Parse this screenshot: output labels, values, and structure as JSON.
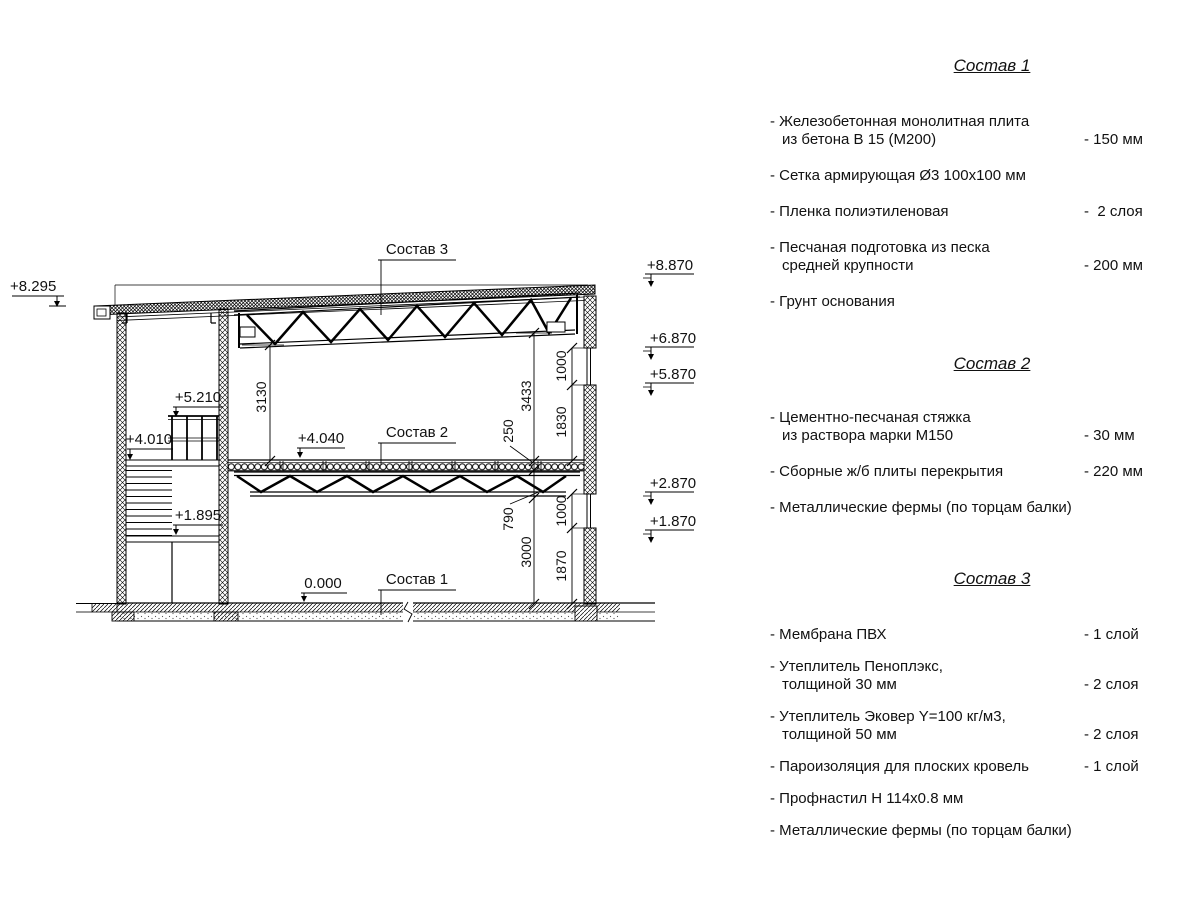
{
  "drawing": {
    "callouts": {
      "c3": "Состав 3",
      "c2": "Состав 2",
      "c1": "Состав 1"
    },
    "elevations": {
      "m8295": "+8.295",
      "m8870": "+8.870",
      "m6870": "+6.870",
      "m5870": "+5.870",
      "m2870": "+2.870",
      "m1870": "+1.870",
      "m5210": "+5.210",
      "m4010": "+4.010",
      "m1895": "+1.895",
      "m4040": "+4.040",
      "m0000": "0.000"
    },
    "dims": {
      "d3130": "3130",
      "d3433": "3433",
      "d250": "250",
      "d790": "790",
      "d3000": "3000",
      "d1000a": "1000",
      "d1830": "1830",
      "d1000b": "1000",
      "d1870": "1870"
    },
    "line_color": "#000000",
    "background_color": "#ffffff"
  },
  "specs": {
    "sections": [
      {
        "title": "Состав 1",
        "items": [
          {
            "line1": "- Железобетонная  монолитная плита",
            "line2": "из бетона В 15 (М200)",
            "value": "- 150 мм"
          },
          {
            "line1": "- Сетка армирующая Ø3 100x100 мм"
          },
          {
            "line1": "- Пленка полиэтиленовая",
            "value": "-  2 слоя"
          },
          {
            "line1": "- Песчаная подготовка из песка",
            "line2": "средней крупности",
            "value": "- 200 мм"
          },
          {
            "line1": "- Грунт основания"
          }
        ]
      },
      {
        "title": "Состав 2",
        "items": [
          {
            "line1": "- Цементно-песчаная стяжка",
            "line2": "из раствора марки М150",
            "value": "- 30 мм"
          },
          {
            "line1": "- Сборные ж/б плиты перекрытия",
            "value": "- 220 мм"
          },
          {
            "line1": "- Металлические фермы (по торцам балки)"
          }
        ]
      },
      {
        "title": "Состав 3",
        "items": [
          {
            "line1": "- Мембрана ПВХ",
            "value": "- 1 слой"
          },
          {
            "line1": "- Утеплитель Пеноплэкс,",
            "line2": "толщиной 30 мм",
            "value": "- 2 слоя"
          },
          {
            "line1": "- Утеплитель Эковер Y=100 кг/м3,",
            "line2": "толщиной 50 мм",
            "value": "- 2 слоя"
          },
          {
            "line1": "- Пароизоляция для плоских кровель",
            "value": "- 1 слой"
          },
          {
            "line1": "- Профнастил Н 114x0.8 мм"
          },
          {
            "line1": "- Металлические фермы (по торцам балки)"
          }
        ]
      }
    ]
  }
}
